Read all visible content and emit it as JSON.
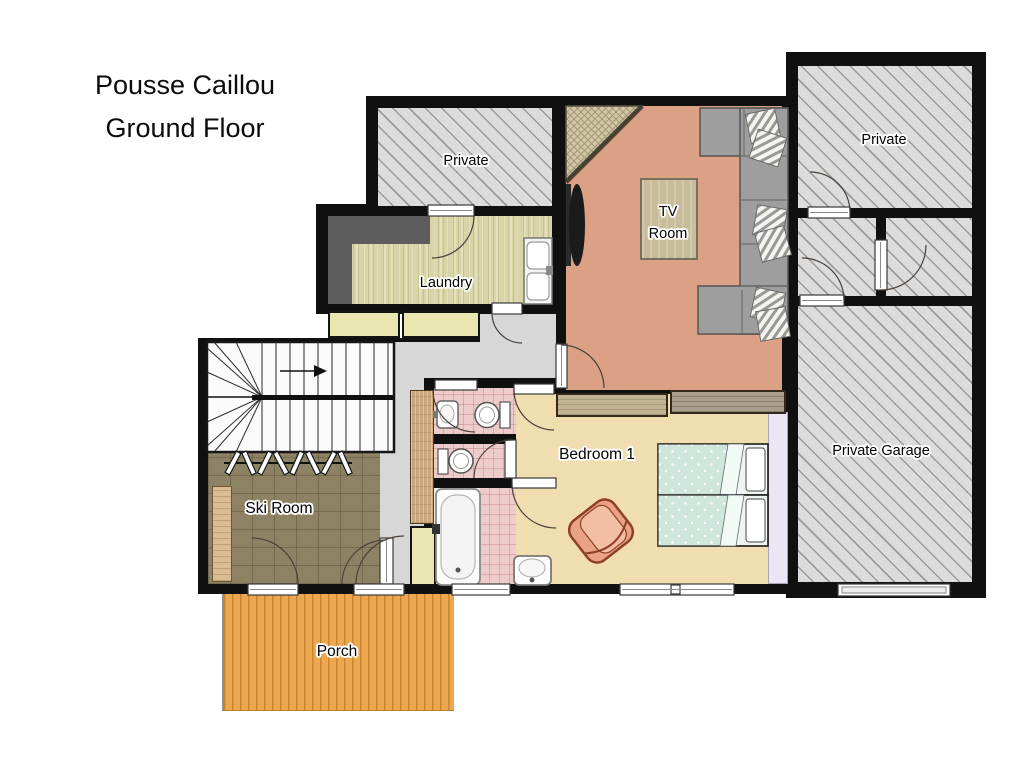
{
  "title": {
    "line1": "Pousse Caillou",
    "line2": "Ground Floor"
  },
  "rooms": {
    "private_top_left": {
      "label": "Private"
    },
    "laundry": {
      "label": "Laundry"
    },
    "tv_room": {
      "line1": "TV",
      "line2": "Room"
    },
    "private_top_right": {
      "label": "Private"
    },
    "private_garage": {
      "label": "Private Garage"
    },
    "bedroom_1": {
      "label": "Bedroom 1"
    },
    "ski_room": {
      "label": "Ski Room"
    },
    "porch": {
      "label": "Porch"
    }
  },
  "colors": {
    "wall": "#101010",
    "hatch_fill": "#dcdcdc",
    "hatch_line": "#9a9a9a",
    "tv_room_floor": "#dca184",
    "bedroom_floor": "#f0ddb0",
    "laundry_floor": "#d9d5a7",
    "ski_room_floor": "#8e8264",
    "hall_floor": "#d7d7d7",
    "bathroom_tile": "#eecccb",
    "porch_deck": "#eca74f",
    "cabinet_yellow": "#eae6af",
    "counter_gray": "#5d5d5d",
    "sofa_gray": "#9e9e9e",
    "bed_cover_mint": "#cfe6da",
    "armchair_salmon": "#e9a285",
    "closet_lavender": "#ece6f4",
    "rug_tan": "#c9bc9b",
    "wood_tan": "#cba87c"
  }
}
